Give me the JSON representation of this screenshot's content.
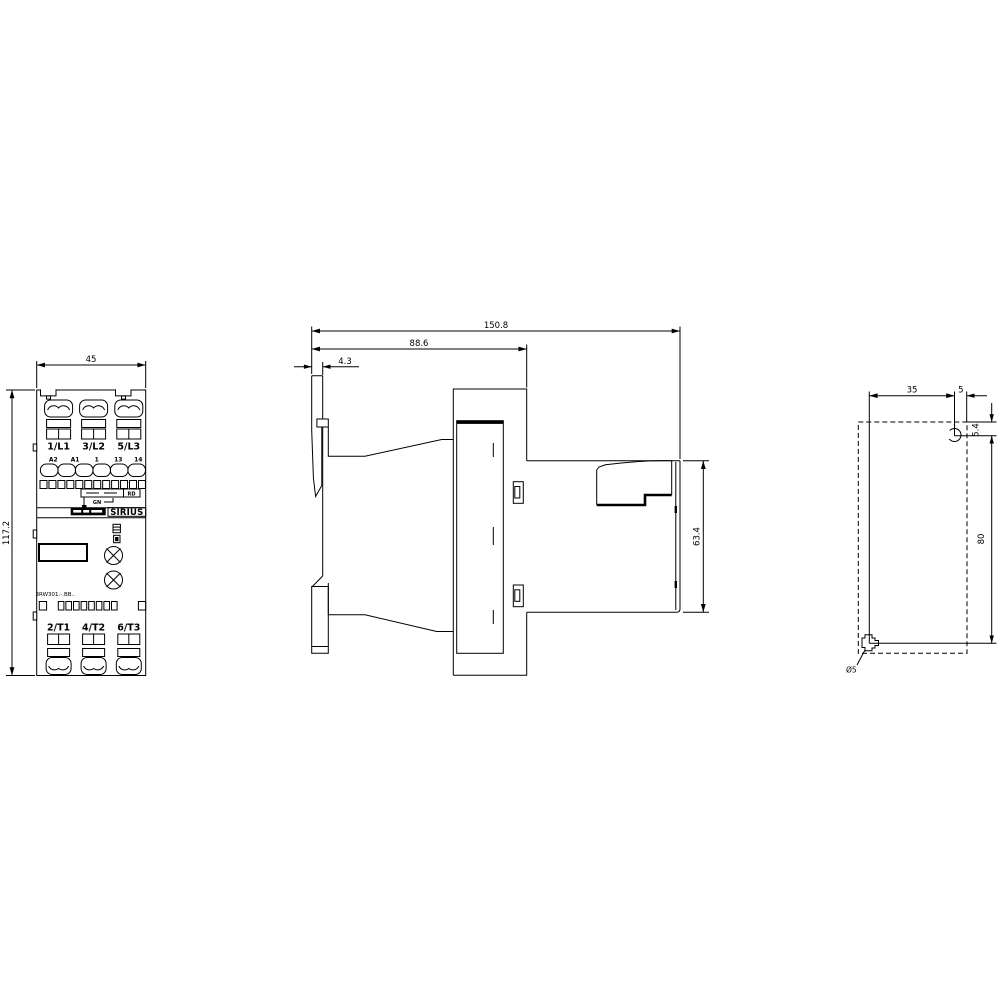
{
  "front_view": {
    "width_dim": "45",
    "height_dim": "117.2",
    "top_terminals": [
      "1/L1",
      "3/L2",
      "5/L3"
    ],
    "aux_terminals": [
      "A2",
      "A1",
      "1",
      "13",
      "14"
    ],
    "led_red": "RD",
    "led_green": "GN",
    "brand": "SIRIUS",
    "type_code": "3RW301.-.BB..",
    "bottom_terminals": [
      "2/T1",
      "4/T2",
      "6/T3"
    ]
  },
  "side_view": {
    "total_depth": "150.8",
    "body_depth": "88.6",
    "front_offset": "4.3",
    "rear_height": "63.4"
  },
  "mounting_view": {
    "hole_spacing_horizontal": "35",
    "edge_offset": "5",
    "top_offset": "5.4",
    "hole_spacing_vertical": "80",
    "hole_diameter": "Ø5"
  },
  "colors": {
    "line": "#000000",
    "background": "#ffffff"
  }
}
